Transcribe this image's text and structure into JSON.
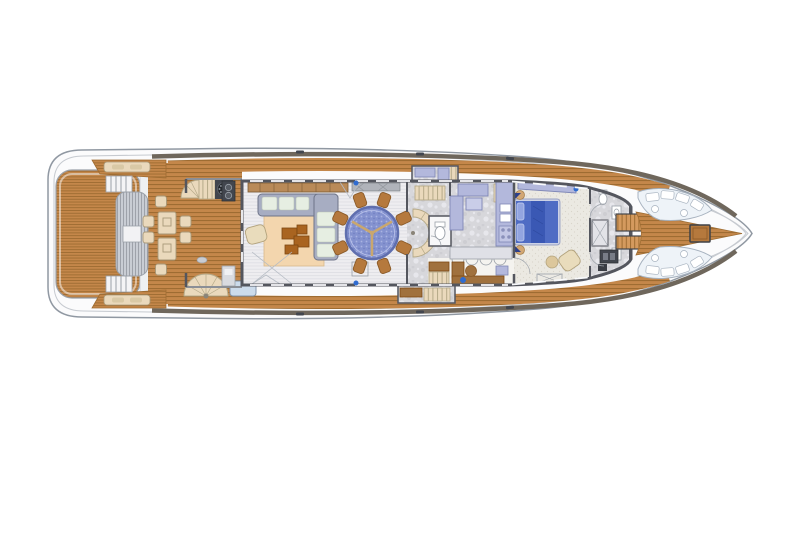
{
  "scene": {
    "type": "yacht-main-deck-floor-plan",
    "view": "top-down",
    "orientation": "bow-right"
  },
  "zones": [
    "swim-platform",
    "aft-deck",
    "al-fresco-dining",
    "transom-bench",
    "side-walkway-port",
    "side-walkway-starboard",
    "main-salon",
    "dining-area",
    "stair-lobby",
    "day-head",
    "galley",
    "office",
    "master-cabin",
    "master-bathroom",
    "foredeck-lounge",
    "bow-seating"
  ],
  "colors": {
    "white": "#ffffff",
    "hull": "#fbfbfc",
    "hull_line": "#9098a2",
    "inner_line": "#c6cad0",
    "bulwark": "#6f675c",
    "wall": "#54565e",
    "trim": "#9aa0a8",
    "teak": "#c4874a",
    "teak_line": "#9e6c32",
    "teak_light": "#d49a5e",
    "salon_floor": "#eeedf0",
    "salon_stripe": "#dddde3",
    "marble": "#d7d7db",
    "marble_dark": "#c6c6cc",
    "marble_light": "#e7e7ec",
    "carpet": "#ebe9e2",
    "carpet_dot": "#d9d5cb",
    "counter": "#b3b8dc",
    "counter_edge": "#7f87b6",
    "counter_light": "#c9cde8",
    "sofa": "#a7adc2",
    "sofa_edge": "#6e7488",
    "cushion": "#e6eee2",
    "cushion_edge": "#b9c4b4",
    "rug": "#f3d6ae",
    "rug_edge": "#d9b98a",
    "coffee": "#a96420",
    "coffee_edge": "#7c4812",
    "armchair": "#e9dcbc",
    "armchair_edge": "#b3a37d",
    "table_blue": "#8492cf",
    "table_blue_dot": "#aab4e2",
    "table_ring": "#5f6eae",
    "table_spoke": "#c9a76e",
    "chair_wood": "#b5793d",
    "chair_edge": "#8a5a28",
    "bed": "#4f6cc4",
    "bed_dark": "#3a58b4",
    "bed_light": "#93a5e0",
    "bed_frame": "#ccd2e6",
    "side_table": "#d2a774",
    "stair": "#ead9bc",
    "stair_line": "#b5a988",
    "bench_blue": "#ccdbeb",
    "bench_edge": "#8496ac",
    "pad": "#eef3f8",
    "pad_edge": "#a7b2bf",
    "gear": "#42464e",
    "gear_light": "#787d87",
    "office_brown": "#a0713e",
    "office_floor": "#f4f3ef",
    "sideboard": "#b98a58",
    "sideboard_edge": "#7c5a34",
    "cream": "#ead9bc",
    "cream_edge": "#a89878",
    "slat_gray": "#c9cdd4",
    "slat_line": "#999da6",
    "accent_blue": "#2f6bd0"
  }
}
